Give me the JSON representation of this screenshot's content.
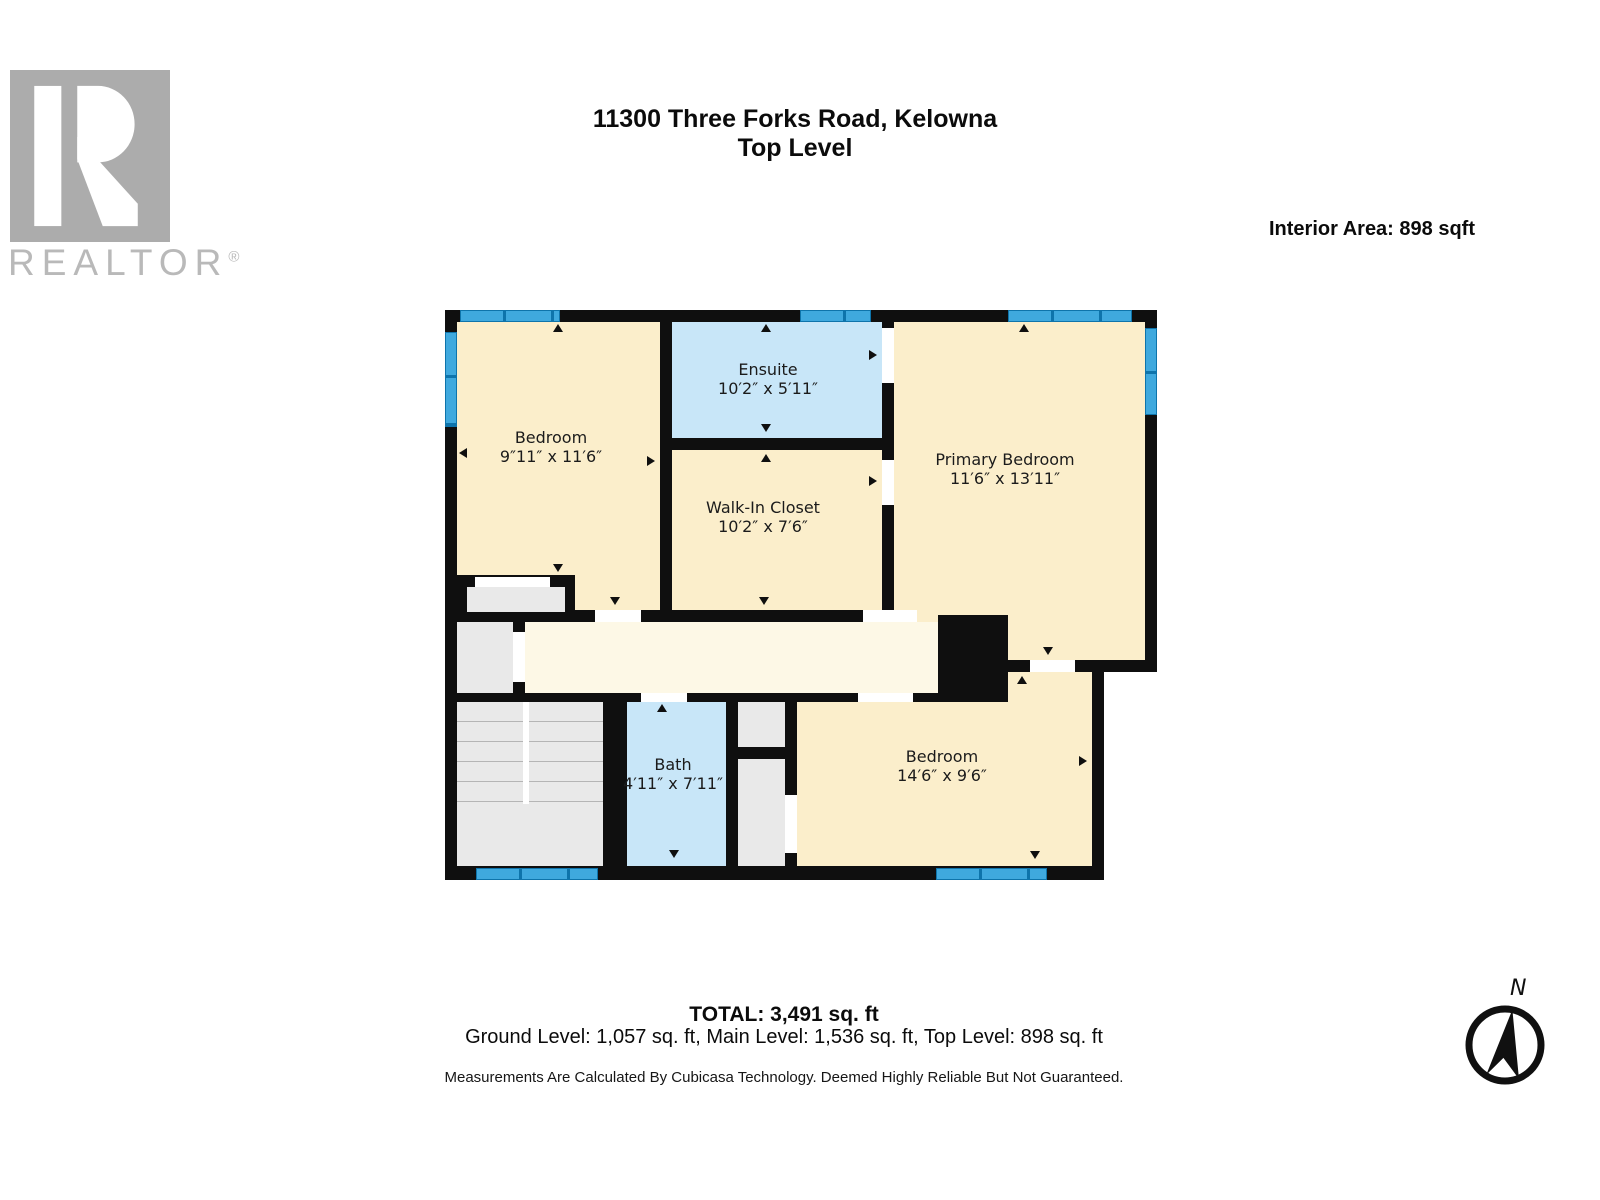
{
  "header": {
    "logo_brand": "REALTOR",
    "logo_registered": "®",
    "title_line1": "11300 Three Forks Road, Kelowna",
    "title_line2": "Top Level",
    "interior_area": "Interior Area: 898 sqft"
  },
  "floorplan": {
    "rooms": [
      {
        "id": "bedroom-top-left",
        "name": "Bedroom",
        "dims": "9″11″ x 11′6″"
      },
      {
        "id": "ensuite",
        "name": "Ensuite",
        "dims": "10′2″ x 5′11″"
      },
      {
        "id": "walk-in-closet",
        "name": "Walk-In Closet",
        "dims": "10′2″ x 7′6″"
      },
      {
        "id": "primary-bedroom",
        "name": "Primary Bedroom",
        "dims": "11′6″ x 13′11″"
      },
      {
        "id": "bath",
        "name": "Bath",
        "dims": "4′11″ x 7′11″"
      },
      {
        "id": "bedroom-bottom-right",
        "name": "Bedroom",
        "dims": "14′6″ x 9′6″"
      }
    ],
    "colors": {
      "wall": "#0f0f0f",
      "room_fill": "#fbeecb",
      "hallway_fill": "#fdf8e6",
      "wet_room_fill": "#c8e6f8",
      "window_blue": "#3fa9de",
      "closet_gray": "#e9e9e9",
      "logo_gray": "#acacac"
    }
  },
  "footer": {
    "total": "TOTAL: 3,491 sq. ft",
    "levels": "Ground Level: 1,057 sq. ft, Main Level: 1,536 sq. ft, Top Level: 898 sq. ft",
    "disclaimer": "Measurements Are Calculated By Cubicasa Technology. Deemed Highly Reliable But Not Guaranteed.",
    "compass_label": "N"
  }
}
